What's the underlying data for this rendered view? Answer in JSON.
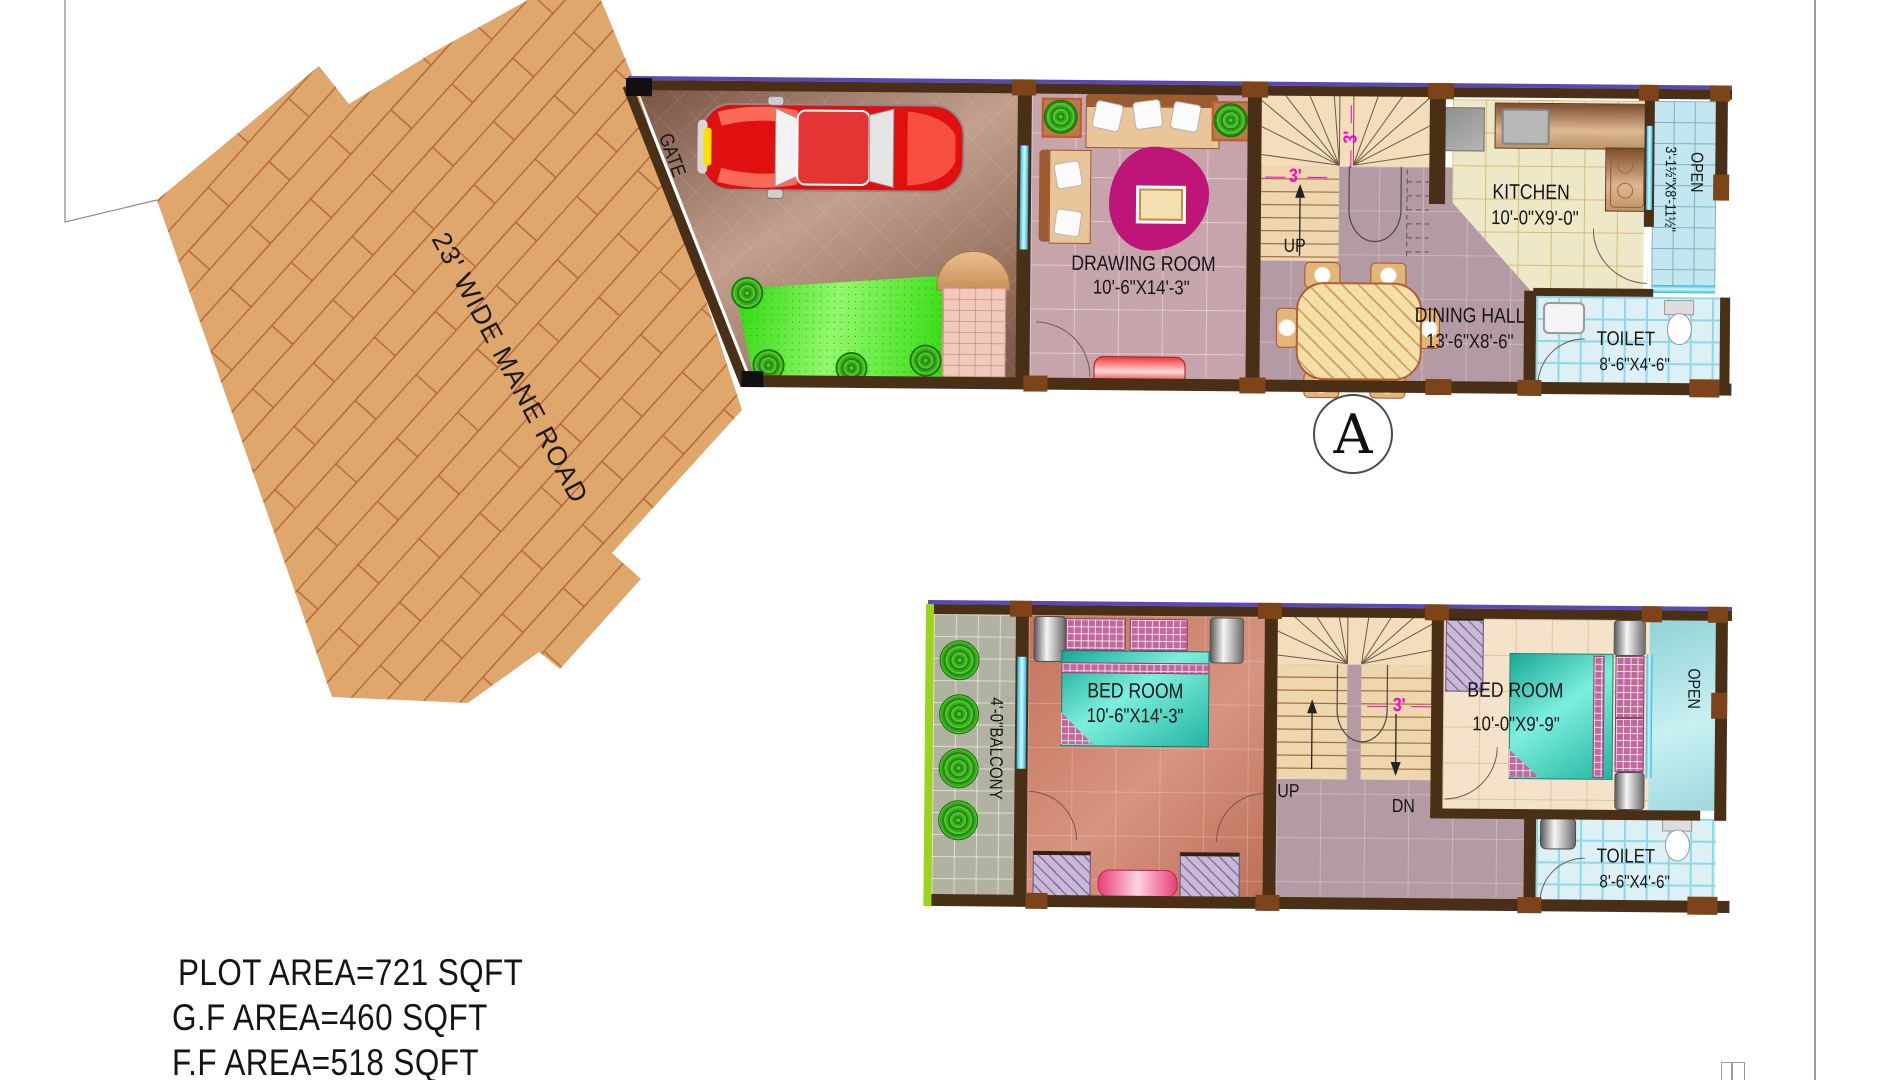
{
  "road": {
    "label": "23' WIDE MANE ROAD"
  },
  "section_marker": {
    "letter": "A"
  },
  "ground_floor": {
    "gate": "GATE",
    "up": "UP",
    "stair_width_top": "3'",
    "stair_width_side": "3'",
    "drawing_room": {
      "name": "DRAWING ROOM",
      "dims": "10'-6\"X14'-3\""
    },
    "dining_hall": {
      "name": "DINING HALL",
      "dims": "13'-6\"X8'-6\""
    },
    "kitchen": {
      "name": "KITCHEN",
      "dims": "10'-0\"X9'-0\""
    },
    "toilet": {
      "name": "TOILET",
      "dims": "8'-6\"X4'-6\""
    },
    "open": {
      "name": "OPEN",
      "dims": "3'-1½\"X8'-11½\""
    }
  },
  "first_floor": {
    "balcony": "4'-0\"BALCONY",
    "up": "UP",
    "dn": "DN",
    "stair_width": "3'",
    "bedroom_large": {
      "name": "BED ROOM",
      "dims": "10'-6\"X14'-3\""
    },
    "bedroom_small": {
      "name": "BED ROOM",
      "dims": "10'-0\"X9'-9\""
    },
    "toilet": {
      "name": "TOILET",
      "dims": "8'-6\"X4'-6\""
    },
    "open": "OPEN"
  },
  "areas": {
    "plot": "PLOT AREA=721 SQFT",
    "ground": "G.F AREA=460 SQFT",
    "first": "F.F AREA=518 SQFT"
  },
  "colors": {
    "road": "#dfa76c",
    "brick_line": "#b9653a",
    "wall": "#4a2f17",
    "lintel": "#5948b8",
    "lawn": "#2ad804",
    "bed": "#2ec4b0",
    "dimension": "#ff00cc"
  }
}
